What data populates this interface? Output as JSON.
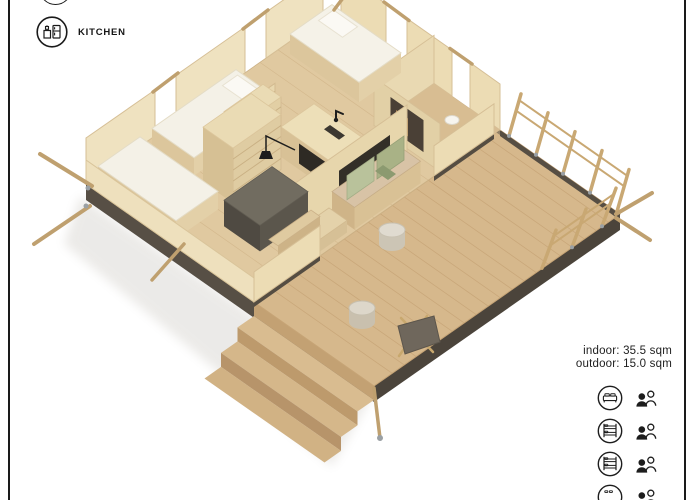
{
  "frame": {
    "border_color": "#1a1a1a"
  },
  "kitchen_legend": {
    "label": "KITCHEN",
    "icon": "kitchen-appliances-icon",
    "partial_icon_above": "cropped-circle-icon"
  },
  "area_info": {
    "indoor": "indoor: 35.5 sqm",
    "outdoor": "outdoor: 15.0 sqm"
  },
  "capacity_legend": {
    "rows": [
      {
        "bed_icon": "double-bed-icon",
        "occupants_icon": "two-persons-icon"
      },
      {
        "bed_icon": "bunk-bed-icon",
        "occupants_icon": "two-persons-icon"
      },
      {
        "bed_icon": "bunk-bed-icon",
        "occupants_icon": "two-persons-icon"
      },
      {
        "bed_icon": "cropped-bed-icon",
        "occupants_icon": "two-persons-icon"
      }
    ]
  },
  "floorplan": {
    "type": "isometric-3d-render",
    "elements": [
      "double-bed",
      "single-bed",
      "bunk-ladder",
      "wardrobe",
      "shelf-unit",
      "kitchen-counter",
      "bathroom",
      "sofa",
      "coffee-table",
      "dining-table",
      "bench",
      "stools",
      "deck",
      "deck-chair",
      "steps",
      "railing",
      "tent-poles"
    ],
    "colors": {
      "wall_light": "#efe2c0",
      "floor_wood": "#e0c9a0",
      "deck_wood": "#d6b88c",
      "foundation_dark": "#554d42",
      "bedding_white": "#f5f2e8",
      "sofa_green": "#a9b286",
      "sofa_green_light": "#b9c29b",
      "table_dark": "#716c60",
      "black_accent": "#1d1d1d",
      "pole_wood": "#c9a873"
    }
  }
}
